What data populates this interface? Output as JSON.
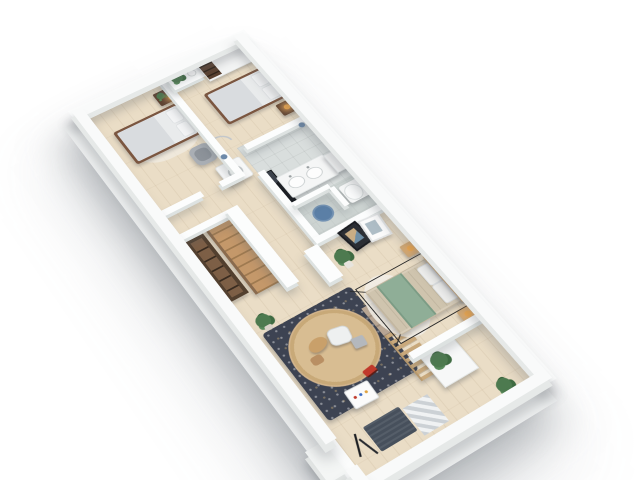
{
  "scene": {
    "kind": "isometric 3D floor plan render",
    "background": "#ffffff",
    "text_visible": "none"
  },
  "palette": {
    "wall_top": "#fcfdfd",
    "wall_face": "#dde2e1",
    "slab_face": "#eff1f1",
    "floor_wood": "#eaddc6",
    "floor_tile": "#d9dedd",
    "walnut_dark": "#7b5640",
    "walnut_shelf": "#53402f",
    "oak_light": "#c9a87c",
    "stair_wood": "#b98f63",
    "duvet_white": "#e4e7e8",
    "duvet_beige": "#cfc4ae",
    "throw_green": "#8fae97",
    "rug_dark": "#3d4352",
    "rug_round": "#d2b48c",
    "shower_mat_blue": "#5b7fa6",
    "toy_car_red": "#c0392b",
    "plant_green": "#4d7a4f",
    "lamp_amber": "#f0a94e",
    "mirror_dark": "#171a1f",
    "door_marker_blue": "#6d89a9"
  },
  "inventory": {
    "bedroom_top_left": [
      "double bed walnut frame white duvet",
      "two white pillows",
      "dark nightstand with plant and lit lamp",
      "light area rug",
      "gray armchair",
      "chrome clothes-rack arc"
    ],
    "bedroom_top_right": [
      "double bed walnut frame white duvet",
      "two white pillows",
      "dark nightstand with lit lamp",
      "white wardrobe with dark open shelves",
      "half-wall ledge with plant and cup"
    ],
    "hallway": [
      "white washing machine with round door"
    ],
    "bathroom": [
      "leaning dark mirror",
      "white double-sink vanity",
      "white cabinet",
      "toilet",
      "blue round shower mat",
      "tiled gray floor"
    ],
    "stairwell": [
      "wooden staircase",
      "dark walnut shelf unit",
      "white half walls"
    ],
    "master_bedroom": [
      "bed with beige duvet and sage green throw",
      "thin black bed frame",
      "light oak headboard and nightstands",
      "two lit lamps",
      "white oval rug",
      "two leaning art frames",
      "potted plant"
    ],
    "play_area": [
      "dark speckled rug",
      "round jute rug",
      "wooden toy animal",
      "white play table",
      "gray cube stool",
      "red toy car",
      "white toy box with colored marks",
      "tan step platform",
      "wooden slat fence"
    ],
    "entry": [
      "dark doormat",
      "checkered tile mat",
      "black coat rack",
      "outside white step"
    ],
    "terrace": [
      "white planter box with plant",
      "small plant on parapet wall"
    ]
  }
}
